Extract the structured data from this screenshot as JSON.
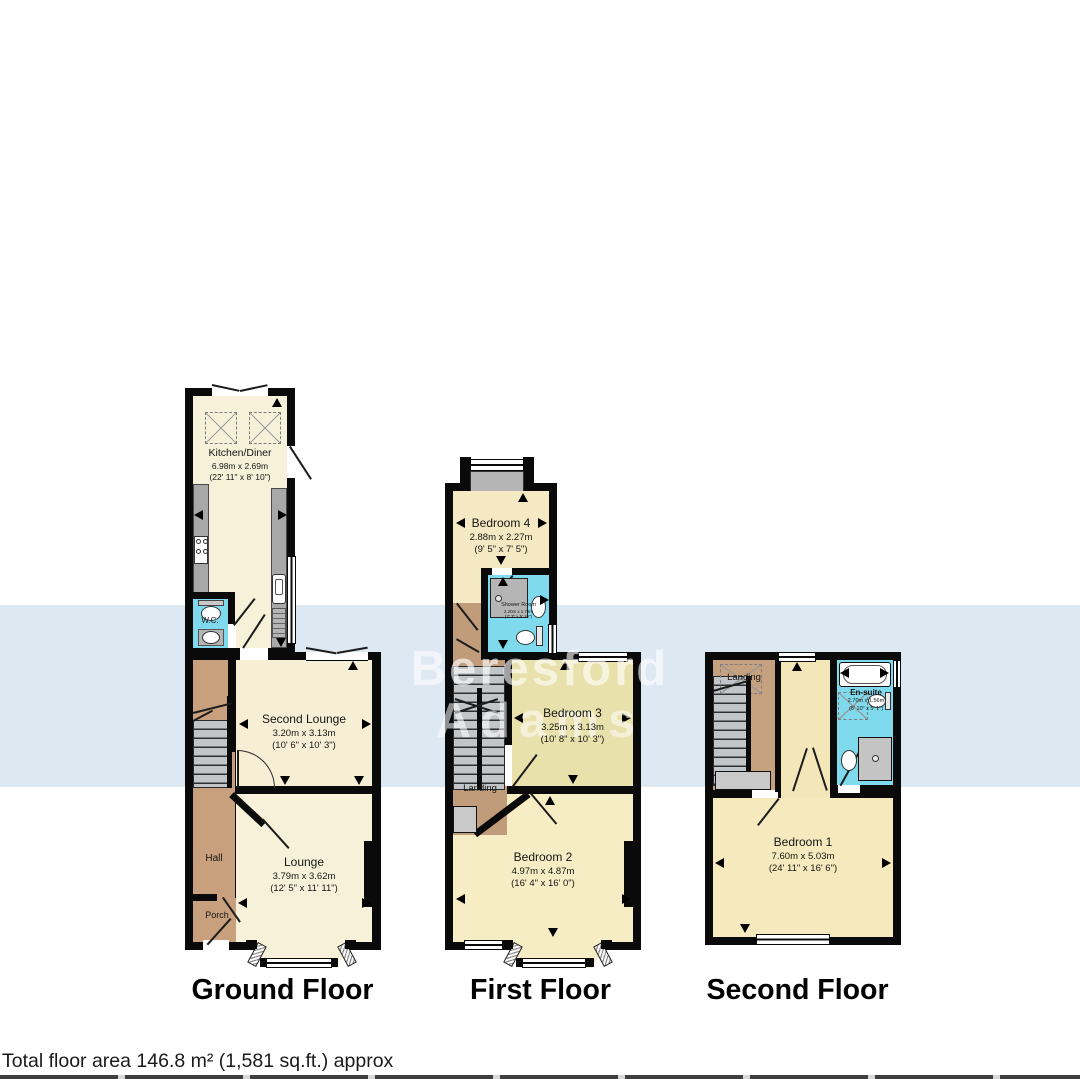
{
  "floors": {
    "ground": "Ground Floor",
    "first": "First Floor",
    "second": "Second Floor"
  },
  "rooms": {
    "kitchen": {
      "name": "Kitchen/Diner",
      "metric": "6.98m x 2.69m",
      "imperial": "(22' 11\" x 8' 10\")"
    },
    "wc": {
      "name": "W.C."
    },
    "second_lounge": {
      "name": "Second Lounge",
      "metric": "3.20m x 3.13m",
      "imperial": "(10' 6\" x 10' 3\")"
    },
    "lounge": {
      "name": "Lounge",
      "metric": "3.79m x 3.62m",
      "imperial": "(12' 5\" x 11' 11\")"
    },
    "hall": {
      "name": "Hall"
    },
    "porch": {
      "name": "Porch"
    },
    "bedroom4": {
      "name": "Bedroom 4",
      "metric": "2.88m x 2.27m",
      "imperial": "(9' 5\" x 7' 5\")"
    },
    "shower_room": {
      "name": "Shower Room",
      "metric": "2.20m x 1.79m",
      "imperial": "(7' 3\" x 5' 10\")"
    },
    "bedroom3": {
      "name": "Bedroom 3",
      "metric": "3.25m x 3.13m",
      "imperial": "(10' 8\" x 10' 3\")"
    },
    "landing_first": {
      "name": "Landing"
    },
    "bedroom2": {
      "name": "Bedroom 2",
      "metric": "4.97m x 4.87m",
      "imperial": "(16' 4\" x 16' 0\")"
    },
    "landing_second": {
      "name": "Landing"
    },
    "ensuite": {
      "name": "En-suite",
      "metric": "2.70m x 1.56m",
      "imperial": "(8' 10\" x 5' 1\")"
    },
    "bedroom1": {
      "name": "Bedroom 1",
      "metric": "7.60m x 5.03m",
      "imperial": "(24' 11\" x 16' 6\")"
    }
  },
  "watermark": {
    "line1": "Beresford",
    "line2": "Adams"
  },
  "footer": {
    "total_area": "Total floor area 146.8 m² (1,581 sq.ft.) approx"
  },
  "colors": {
    "wall": "#0a0a0a",
    "room_cream": "#f8f1da",
    "room_yellow": "#f5e9bd",
    "bath_cyan": "#7edaec",
    "hall_tan": "#c8a07e",
    "counter_gray": "#a8a8a8",
    "watermark_band": "#dce8f2"
  }
}
